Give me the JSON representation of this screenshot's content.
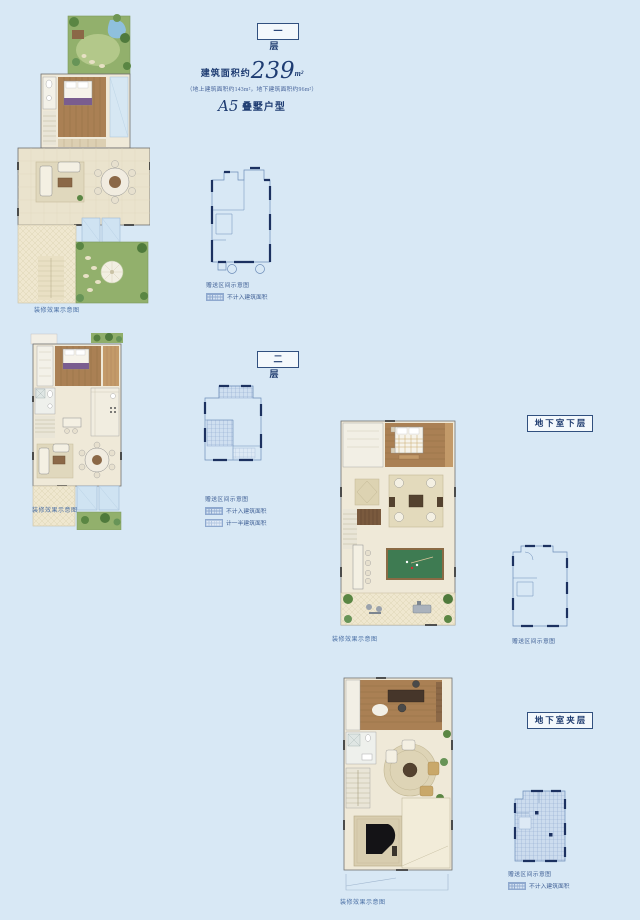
{
  "page": {
    "background": "#d8e8f5",
    "accent": "#1e3c72"
  },
  "header": {
    "area_prefix": "建筑面积约",
    "area_value": "239",
    "area_unit": "m²",
    "area_note": "（地上建筑面积约143m²，地下建筑面积约96m²）",
    "type_code": "A5",
    "type_name": "叠墅户型"
  },
  "sections": [
    {
      "label": "一层",
      "caption": "装修效果示意图",
      "legend_title": "赠送区间示意图",
      "legend": [
        {
          "style": "dense",
          "label": "不计入建筑面积"
        }
      ]
    },
    {
      "label": "二层",
      "caption": "装修效果示意图",
      "legend_title": "赠送区间示意图",
      "legend": [
        {
          "style": "dense",
          "label": "不计入建筑面积"
        },
        {
          "style": "light",
          "label": "计一半建筑面积"
        }
      ]
    },
    {
      "label": "地下室下层",
      "caption": "装修效果示意图",
      "legend_title": "赠送区间示意图",
      "legend": []
    },
    {
      "label": "地下室夹层",
      "caption": "装修效果示意图",
      "legend_title": "赠送区间示意图",
      "legend": [
        {
          "style": "dense",
          "label": "不计入建筑面积"
        }
      ]
    }
  ]
}
